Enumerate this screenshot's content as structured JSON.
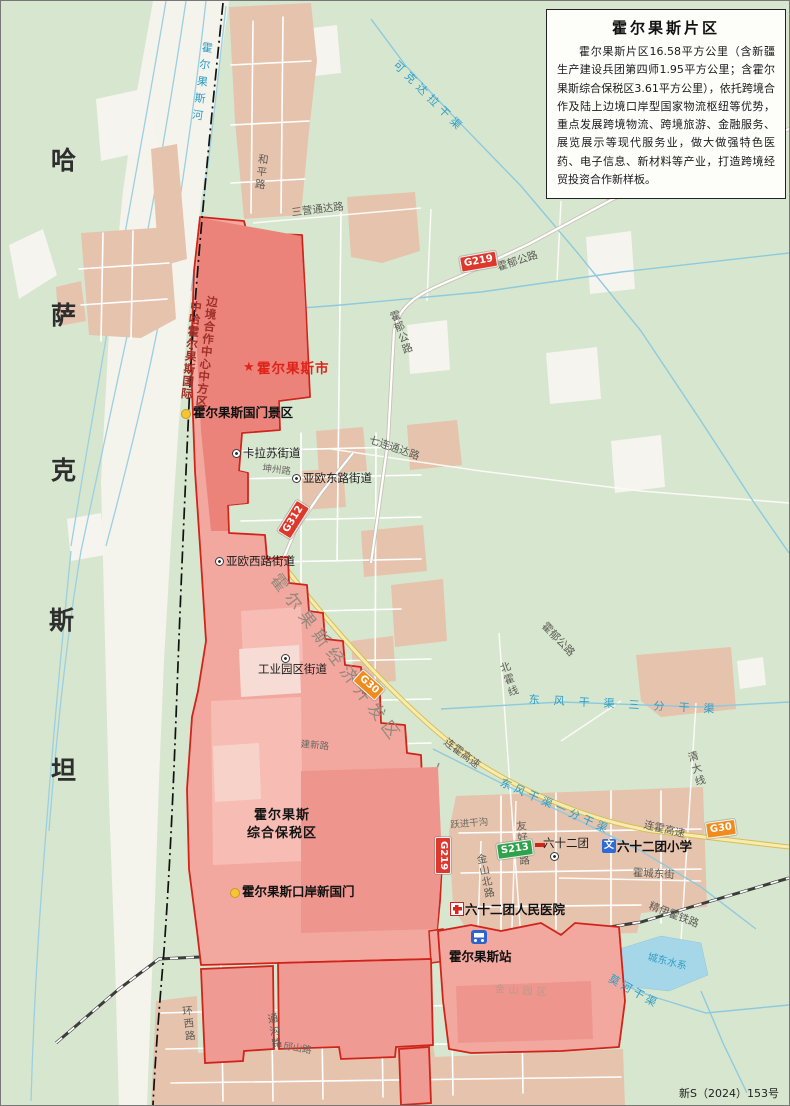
{
  "title_box": {
    "title": "霍尔果斯片区",
    "body": "霍尔果斯片区16.58平方公里（含新疆生产建设兵团第四师1.95平方公里；含霍尔果斯综合保税区3.61平方公里），依托跨境合作及陆上边境口岸型国家物流枢纽等优势，重点发展跨境物流、跨境旅游、金融服务、展览展示等现代服务业，做大做强特色医药、电子信息、新材料等产业，打造跨境经贸投资合作新样板。"
  },
  "footer_note": "新S（2024）153号",
  "country_label": "哈萨克斯坦",
  "colors": {
    "land_green": "#d7e6cf",
    "floodplain": "#f4f3ec",
    "urban_tan": "#e6c3ad",
    "zone_fill": "#f3a89f",
    "zone_dark": "#ee8b84",
    "zone_stroke": "#d0241b",
    "water": "#8ecadd",
    "expressway": "#f7ecb0",
    "badge_national": "#dd382b",
    "badge_provincial": "#31a24c",
    "badge_expressway": "#f08c1e"
  },
  "labels": [
    {
      "n": "country-char-ha",
      "t": "哈",
      "x": 50,
      "y": 146,
      "c": "country",
      "r": 0
    },
    {
      "n": "country-char-sa",
      "t": "萨",
      "x": 50,
      "y": 301,
      "c": "country",
      "r": 0
    },
    {
      "n": "country-char-ke",
      "t": "克",
      "x": 50,
      "y": 456,
      "c": "country",
      "r": 0
    },
    {
      "n": "country-char-si",
      "t": "斯",
      "x": 48,
      "y": 606,
      "c": "country",
      "r": 0
    },
    {
      "n": "country-char-tan",
      "t": "坦",
      "x": 50,
      "y": 756,
      "c": "country",
      "r": 0
    },
    {
      "n": "river-horgos",
      "t": "霍尔果斯河",
      "x": 200,
      "y": 40,
      "c": "water v sp6",
      "r": 8
    },
    {
      "n": "road-heping",
      "t": "和平路",
      "x": 256,
      "y": 152,
      "c": "road v sp2",
      "r": 7
    },
    {
      "n": "road-sanying-tongda",
      "t": "三营通达路",
      "x": 290,
      "y": 207,
      "c": "road",
      "r": -7
    },
    {
      "n": "canal-kekedala",
      "t": "可克达拉干渠",
      "x": 398,
      "y": 58,
      "c": "water sp5",
      "r": 45
    },
    {
      "n": "road-huoyu-1",
      "t": "霍郁公路",
      "x": 495,
      "y": 262,
      "c": "road",
      "r": -18
    },
    {
      "n": "road-huoyu-2",
      "t": "霍郁公路",
      "x": 386,
      "y": 312,
      "c": "road v sp1",
      "r": -20
    },
    {
      "n": "road-huoyu-3",
      "t": "霍郁公路",
      "x": 546,
      "y": 620,
      "c": "road",
      "r": 46
    },
    {
      "n": "road-qilian-tongda",
      "t": "七连通达路",
      "x": 370,
      "y": 434,
      "c": "road",
      "r": 19
    },
    {
      "n": "road-kunzhou",
      "t": "坤州路",
      "x": 262,
      "y": 463,
      "c": "road-sm",
      "r": 7
    },
    {
      "n": "poi-kalasu-subdistrict",
      "t": "卡拉苏街道",
      "x": 242,
      "y": 446,
      "c": "poi",
      "r": 0
    },
    {
      "n": "poi-yaou-east-subdistrict",
      "t": "亚欧东路街道",
      "x": 302,
      "y": 471,
      "c": "poi",
      "r": 0
    },
    {
      "n": "poi-yaou-west-subdistrict",
      "t": "亚欧西路街道",
      "x": 225,
      "y": 554,
      "c": "poi",
      "r": 0
    },
    {
      "n": "poi-industrial-park-subdistrict",
      "t": "工业园区街道",
      "x": 257,
      "y": 662,
      "c": "poi",
      "r": 0
    },
    {
      "n": "city-horgos",
      "t": "霍尔果斯市",
      "x": 256,
      "y": 361,
      "c": "city",
      "r": 0
    },
    {
      "n": "zone-cooperation-center-col1",
      "t": "中哈霍尔果斯国际",
      "x": 189,
      "y": 299,
      "c": "zonev v sp1",
      "r": 6
    },
    {
      "n": "zone-cooperation-center-col2",
      "t": "边境合作中心中方区",
      "x": 205,
      "y": 294,
      "c": "zonev v sp1",
      "r": 6
    },
    {
      "n": "poi-guomen-scenic",
      "t": "霍尔果斯国门景区",
      "x": 192,
      "y": 405,
      "c": "poib",
      "r": 0
    },
    {
      "n": "zone-economic-dev",
      "t": "霍尔果斯经济开发区",
      "x": 280,
      "y": 570,
      "c": "bigzone",
      "r": 53
    },
    {
      "n": "road-jianxin",
      "t": "建新路",
      "x": 300,
      "y": 739,
      "c": "road-sm",
      "r": 5
    },
    {
      "n": "road-beihuo-line",
      "t": "北霍线",
      "x": 496,
      "y": 663,
      "c": "road v sp2",
      "r": -18
    },
    {
      "n": "road-qingda-line",
      "t": "清大线",
      "x": 684,
      "y": 752,
      "c": "road v sp2",
      "r": -16
    },
    {
      "n": "canal-dongfeng-3",
      "t": "东风干渠三分干渠",
      "x": 528,
      "y": 693,
      "c": "water sp14",
      "r": 3
    },
    {
      "n": "canal-dongfeng-1",
      "t": "东风干渠一分干渠",
      "x": 502,
      "y": 776,
      "c": "water sp4",
      "r": 24
    },
    {
      "n": "hw-lianhuo-1",
      "t": "连霍高速",
      "x": 447,
      "y": 736,
      "c": "road",
      "r": 37
    },
    {
      "n": "hw-lianhuo-2",
      "t": "连霍高速",
      "x": 644,
      "y": 819,
      "c": "road",
      "r": 13
    },
    {
      "n": "ditch-yuejin",
      "t": "跃进干沟",
      "x": 449,
      "y": 820,
      "c": "road-sm",
      "r": -5
    },
    {
      "n": "poi-62tuan",
      "t": "六十二团",
      "x": 542,
      "y": 836,
      "c": "poi",
      "r": 0
    },
    {
      "n": "poi-62tuan-school",
      "t": "六十二团小学",
      "x": 616,
      "y": 839,
      "c": "poib",
      "r": 0
    },
    {
      "n": "road-huocheng-east",
      "t": "霍城东街",
      "x": 632,
      "y": 867,
      "c": "road",
      "r": 3
    },
    {
      "n": "road-jinshan-north",
      "t": "金山北路",
      "x": 473,
      "y": 854,
      "c": "road v sp1",
      "r": -12
    },
    {
      "n": "road-youhao-south",
      "t": "友好南路",
      "x": 513,
      "y": 820,
      "c": "road v sp1",
      "r": -5
    },
    {
      "n": "zone-bonded",
      "t": "霍尔果斯\n综合保税区",
      "x": 246,
      "y": 806,
      "c": "zonename",
      "r": 0
    },
    {
      "n": "poi-new-gate",
      "t": "霍尔果斯口岸新国门",
      "x": 241,
      "y": 884,
      "c": "poib",
      "r": 0
    },
    {
      "n": "poi-62tuan-hospital",
      "t": "六十二团人民医院",
      "x": 464,
      "y": 902,
      "c": "poib",
      "r": 0
    },
    {
      "n": "rail-jingyihuo",
      "t": "精伊霍铁路",
      "x": 650,
      "y": 900,
      "c": "road",
      "r": 21
    },
    {
      "n": "poi-horgos-station",
      "t": "霍尔果斯站",
      "x": 448,
      "y": 949,
      "c": "poib",
      "r": 0
    },
    {
      "n": "water-chengdong",
      "t": "城东水系",
      "x": 648,
      "y": 951,
      "c": "water-sm",
      "r": 14
    },
    {
      "n": "canal-mohe",
      "t": "莫河干渠",
      "x": 611,
      "y": 972,
      "c": "water sp3",
      "r": 29
    },
    {
      "n": "zone-jinshan-park",
      "t": "金山园区",
      "x": 494,
      "y": 983,
      "c": "faint sp4",
      "r": 4
    },
    {
      "n": "road-huanxi",
      "t": "环西路",
      "x": 179,
      "y": 1005,
      "c": "road v sp2",
      "r": -6
    },
    {
      "n": "road-tonggou",
      "t": "通沟路",
      "x": 264,
      "y": 1013,
      "c": "road v sp2",
      "r": -9
    },
    {
      "n": "road-qiushan",
      "t": "邱山路",
      "x": 283,
      "y": 1041,
      "c": "road-sm",
      "r": 9
    },
    {
      "n": "badge-g219-1",
      "t": "G219",
      "x": 458,
      "y": 256,
      "c": "badge bred",
      "r": -10
    },
    {
      "n": "badge-g219-2",
      "t": "G219",
      "x": 596,
      "y": 186,
      "c": "badge bred",
      "r": -39
    },
    {
      "n": "badge-g219-3",
      "t": "G219",
      "x": 450,
      "y": 836,
      "c": "badge bred",
      "r": 90
    },
    {
      "n": "badge-g312",
      "t": "G312",
      "x": 276,
      "y": 530,
      "c": "badge bred",
      "r": -58
    },
    {
      "n": "badge-g30-1",
      "t": "G30",
      "x": 362,
      "y": 668,
      "c": "badge borange",
      "r": 42
    },
    {
      "n": "badge-g30-2",
      "t": "G30",
      "x": 704,
      "y": 822,
      "c": "badge borange",
      "r": -8
    },
    {
      "n": "badge-s213",
      "t": "S213",
      "x": 495,
      "y": 843,
      "c": "badge bgreen",
      "r": -8
    }
  ],
  "markers": [
    {
      "n": "star-icon-horgos-city",
      "k": "star",
      "x": 242,
      "y": 360,
      "g": "★"
    },
    {
      "n": "dot-icon-guomen-scenic",
      "k": "dot",
      "x": 180,
      "y": 408
    },
    {
      "n": "dot-icon-new-gate",
      "k": "dot",
      "x": 229,
      "y": 887
    },
    {
      "n": "ring-icon-kalasu",
      "k": "ring",
      "x": 231,
      "y": 448
    },
    {
      "n": "ring-icon-yaou-east",
      "k": "ring",
      "x": 291,
      "y": 473
    },
    {
      "n": "ring-icon-yaou-west",
      "k": "ring",
      "x": 214,
      "y": 556
    },
    {
      "n": "ring-icon-industrial-park",
      "k": "ring",
      "x": 280,
      "y": 653
    },
    {
      "n": "ring-icon-62tuan",
      "k": "ring",
      "x": 549,
      "y": 851
    },
    {
      "n": "school-icon-62tuan",
      "k": "school",
      "x": 601,
      "y": 838,
      "g": "文"
    },
    {
      "n": "hospital-icon-62tuan",
      "k": "hospital",
      "x": 449,
      "y": 901
    },
    {
      "n": "station-icon-horgos",
      "k": "station",
      "x": 470,
      "y": 929
    }
  ]
}
